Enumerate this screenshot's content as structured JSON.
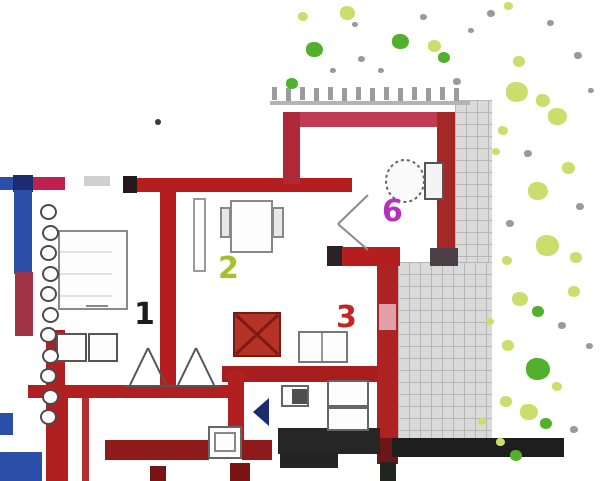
{
  "plan": {
    "canvas": {
      "width": 600,
      "height": 481,
      "background": "#ffffff"
    },
    "room_labels": [
      {
        "name": "room-label-1",
        "text": "1",
        "x": 134,
        "y": 300,
        "color": "#1d1d1d",
        "size": 30
      },
      {
        "name": "room-label-2",
        "text": "2",
        "x": 218,
        "y": 254,
        "color": "#a8bf2c",
        "size": 30
      },
      {
        "name": "room-label-3",
        "text": "3",
        "x": 336,
        "y": 303,
        "color": "#c32424",
        "size": 30
      },
      {
        "name": "room-label-6",
        "text": "6",
        "x": 382,
        "y": 197,
        "color": "#b531bd",
        "size": 30
      }
    ],
    "palette": {
      "wall_red": "#b51e1e",
      "wall_dark_red": "#8e1a1a",
      "wall_rose": "#c23b55",
      "wall_blue": "#2b4fa8",
      "wall_navy": "#1c2a6e",
      "wall_crimson": "#bf2050",
      "tile_gray": "#dadada",
      "band_black": "#1e1e1e",
      "plant_yellow_green": "#cade6e",
      "plant_green": "#53b02c",
      "plant_gray_dot": "#9a9a9a",
      "stove_red": "#b53226"
    },
    "terrace": [
      {
        "name": "terrace-strip-upper",
        "x": 455,
        "y": 100,
        "w": 37,
        "h": 163
      },
      {
        "name": "terrace-main",
        "x": 398,
        "y": 262,
        "w": 94,
        "h": 180
      }
    ],
    "railing": {
      "x0": 272,
      "y": 87,
      "step": 14,
      "count": 14,
      "post_w": 5,
      "post_h": 13,
      "color": "#9c9c9c",
      "line": {
        "x": 270,
        "y": 101,
        "w": 200,
        "h": 4,
        "color": "#b4b4b4"
      }
    },
    "radiator": {
      "x": 40,
      "y0": 204,
      "step": 20.5,
      "count": 11,
      "d": 17
    },
    "walls": [
      {
        "n": "wall-left-blue-h",
        "x": 0,
        "y": 177,
        "w": 14,
        "h": 13,
        "c": "#2b4fa8"
      },
      {
        "n": "wall-left-navy-block",
        "x": 13,
        "y": 175,
        "w": 20,
        "h": 17,
        "c": "#1c2a6e"
      },
      {
        "n": "wall-left-crimson-h",
        "x": 33,
        "y": 177,
        "w": 32,
        "h": 13,
        "c": "#bf2050"
      },
      {
        "n": "wall-left-blue-v",
        "x": 14,
        "y": 190,
        "w": 18,
        "h": 84,
        "c": "#2b4fa8"
      },
      {
        "n": "wall-left-red-v-upper",
        "x": 15,
        "y": 272,
        "w": 18,
        "h": 64,
        "c": "#a03345"
      },
      {
        "n": "wall-left-red-v-lower",
        "x": 46,
        "y": 330,
        "w": 19,
        "h": 151,
        "c": "#b02020"
      },
      {
        "n": "wall-left-red-line",
        "x": 82,
        "y": 397,
        "w": 7,
        "h": 84,
        "c": "#b23030"
      },
      {
        "n": "wall-main-cap-black",
        "x": 123,
        "y": 176,
        "w": 14,
        "h": 17,
        "c": "#27191b"
      },
      {
        "n": "wall-main-red-h",
        "x": 137,
        "y": 178,
        "w": 215,
        "h": 14,
        "c": "#b51e1e"
      },
      {
        "n": "wall-mid-red-v",
        "x": 160,
        "y": 192,
        "w": 16,
        "h": 198,
        "c": "#b51e1e"
      },
      {
        "n": "wall-bath-top",
        "x": 283,
        "y": 112,
        "w": 172,
        "h": 15,
        "c": "#c23b55"
      },
      {
        "n": "wall-bath-left",
        "x": 283,
        "y": 112,
        "w": 17,
        "h": 72,
        "c": "#ad2838"
      },
      {
        "n": "wall-bath-right",
        "x": 437,
        "y": 112,
        "w": 18,
        "h": 140,
        "c": "#a52828"
      },
      {
        "n": "wall-bath-right-cap",
        "x": 430,
        "y": 248,
        "w": 28,
        "h": 18,
        "c": "#4a4045"
      },
      {
        "n": "wall-L-cap-black",
        "x": 327,
        "y": 246,
        "w": 16,
        "h": 20,
        "c": "#2a2226"
      },
      {
        "n": "wall-L-red-h",
        "x": 342,
        "y": 247,
        "w": 58,
        "h": 19,
        "c": "#b51e1e"
      },
      {
        "n": "wall-right-red-v",
        "x": 377,
        "y": 264,
        "w": 21,
        "h": 178,
        "c": "#ad2222"
      },
      {
        "n": "window-right-v",
        "x": 379,
        "y": 304,
        "w": 17,
        "h": 26,
        "c": "#dfa0a8"
      },
      {
        "n": "wall-right-dark-cap",
        "x": 377,
        "y": 438,
        "w": 21,
        "h": 26,
        "c": "#6d1618"
      },
      {
        "n": "wall-right-black-end",
        "x": 380,
        "y": 462,
        "w": 16,
        "h": 19,
        "c": "#20261f"
      },
      {
        "n": "wall-kitchen-red-h",
        "x": 222,
        "y": 366,
        "w": 156,
        "h": 16,
        "c": "#a81d1d"
      },
      {
        "n": "wall-kitchen-red-v",
        "x": 228,
        "y": 371,
        "w": 16,
        "h": 74,
        "c": "#b02020"
      },
      {
        "n": "wall-bottomleft-red-h",
        "x": 28,
        "y": 385,
        "w": 202,
        "h": 13,
        "c": "#b02020"
      },
      {
        "n": "wall-bottomleft-red-v",
        "x": 50,
        "y": 397,
        "w": 18,
        "h": 84,
        "c": "#b02020"
      },
      {
        "n": "band-red-bottom-a",
        "x": 105,
        "y": 440,
        "w": 104,
        "h": 20,
        "c": "#8e1a1a"
      },
      {
        "n": "band-red-bottom-b",
        "x": 242,
        "y": 440,
        "w": 30,
        "h": 20,
        "c": "#8e1a1a"
      },
      {
        "n": "band-black-center",
        "x": 278,
        "y": 428,
        "w": 102,
        "h": 26,
        "c": "#262626"
      },
      {
        "n": "band-black-center-ext",
        "x": 280,
        "y": 452,
        "w": 58,
        "h": 16,
        "c": "#242424"
      },
      {
        "n": "band-black-terrace",
        "x": 392,
        "y": 438,
        "w": 172,
        "h": 19,
        "c": "#1e1e1e"
      },
      {
        "n": "blue-rect-bottom-left",
        "x": 0,
        "y": 452,
        "w": 42,
        "h": 29,
        "c": "#2b4fa8"
      },
      {
        "n": "blue-mark-left",
        "x": 0,
        "y": 413,
        "w": 13,
        "h": 22,
        "c": "#2b4fa8"
      },
      {
        "n": "mark-dark-red-a",
        "x": 150,
        "y": 466,
        "w": 16,
        "h": 15,
        "c": "#7a1414"
      },
      {
        "n": "mark-dark-red-b",
        "x": 230,
        "y": 463,
        "w": 20,
        "h": 18,
        "c": "#7a1414"
      },
      {
        "n": "dot-artifact",
        "x": 155,
        "y": 119,
        "w": 6,
        "h": 6,
        "c": "#3a3a3a",
        "r": 1
      }
    ],
    "stove": {
      "n": "stove",
      "x": 233,
      "y": 312,
      "w": 48,
      "h": 45,
      "fill": "#b53226",
      "border": "#7a1812"
    },
    "fixtures": [
      {
        "n": "bed",
        "x": 58,
        "y": 230,
        "w": 70,
        "h": 80,
        "border": "#8a8a8a"
      },
      {
        "n": "cabinet-a",
        "x": 56,
        "y": 333,
        "w": 31,
        "h": 29,
        "border": "#555555"
      },
      {
        "n": "cabinet-b",
        "x": 88,
        "y": 333,
        "w": 30,
        "h": 29,
        "border": "#555555"
      },
      {
        "n": "door-leaf",
        "x": 193,
        "y": 198,
        "w": 13,
        "h": 74,
        "border": "#999999"
      },
      {
        "n": "table",
        "x": 230,
        "y": 200,
        "w": 43,
        "h": 53,
        "border": "#888888"
      },
      {
        "n": "chair-left",
        "x": 220,
        "y": 207,
        "w": 11,
        "h": 31,
        "border": "#888888",
        "fill": "#e8e8e8"
      },
      {
        "n": "chair-right",
        "x": 272,
        "y": 207,
        "w": 12,
        "h": 31,
        "border": "#888888",
        "fill": "#e8e8e8"
      },
      {
        "n": "kitchen-counter",
        "x": 298,
        "y": 331,
        "w": 50,
        "h": 32,
        "border": "#777777"
      },
      {
        "n": "wc-sink",
        "x": 281,
        "y": 385,
        "w": 28,
        "h": 22,
        "border": "#666666"
      },
      {
        "n": "wc-sink-bowl",
        "x": 292,
        "y": 389,
        "w": 15,
        "h": 15,
        "fill": "#4e4e4e"
      },
      {
        "n": "shower",
        "x": 327,
        "y": 380,
        "w": 42,
        "h": 27,
        "border": "#666666"
      },
      {
        "n": "washer",
        "x": 327,
        "y": 407,
        "w": 42,
        "h": 24,
        "border": "#666666"
      },
      {
        "n": "bottom-fixture",
        "x": 208,
        "y": 426,
        "w": 34,
        "h": 33,
        "border": "#666666"
      },
      {
        "n": "bottom-fixture-inner",
        "x": 214,
        "y": 432,
        "w": 22,
        "h": 20,
        "border": "#888888"
      },
      {
        "n": "toilet-tank",
        "x": 424,
        "y": 162,
        "w": 20,
        "h": 38,
        "border": "#555555",
        "fill": "#f4f4f4"
      },
      {
        "n": "gray-dash",
        "x": 84,
        "y": 176,
        "w": 26,
        "h": 10,
        "fill": "#d0d0d0"
      }
    ],
    "toilet_bowl": {
      "n": "toilet-bowl",
      "cx": 405,
      "cy": 181,
      "rx": 19,
      "ry": 21,
      "stroke": "#666666",
      "dash": "3,3"
    },
    "door_arrow": {
      "n": "door-arrow",
      "points": "269,398 253,412 269,426",
      "fill": "#1c2a6e"
    },
    "line_groups": [
      {
        "n": "stairs-lines",
        "stroke": "#555555",
        "w": 2,
        "segs": [
          [
            125,
            386,
            220,
            386
          ],
          [
            130,
            385,
            148,
            348
          ],
          [
            148,
            348,
            166,
            385
          ],
          [
            178,
            385,
            196,
            348
          ],
          [
            196,
            348,
            214,
            385
          ]
        ]
      },
      {
        "n": "door-swing-lines",
        "stroke": "#8a8a8a",
        "w": 2,
        "segs": [
          [
            368,
            195,
            338,
            224
          ],
          [
            338,
            224,
            368,
            250
          ]
        ]
      },
      {
        "n": "stove-x-lines",
        "stroke": "#7f1a12",
        "w": 3,
        "segs": [
          [
            236,
            315,
            278,
            354
          ],
          [
            278,
            315,
            236,
            354
          ]
        ]
      },
      {
        "n": "counter-divider",
        "stroke": "#777777",
        "w": 1.5,
        "segs": [
          [
            322,
            333,
            322,
            361
          ]
        ]
      },
      {
        "n": "shelf-lines",
        "stroke": "#c8c8c8",
        "w": 1,
        "segs": [
          [
            60,
            252,
            112,
            252
          ],
          [
            60,
            274,
            112,
            274
          ],
          [
            60,
            296,
            112,
            296
          ]
        ]
      },
      {
        "n": "bed-notch",
        "stroke": "#888888",
        "w": 2,
        "segs": [
          [
            86,
            306,
            108,
            306
          ]
        ]
      }
    ],
    "plants": [
      {
        "x": 340,
        "y": 6,
        "s": 15,
        "t": "yg"
      },
      {
        "x": 298,
        "y": 12,
        "s": 10,
        "t": "yg"
      },
      {
        "x": 352,
        "y": 22,
        "s": 6,
        "t": "gray"
      },
      {
        "x": 306,
        "y": 42,
        "s": 17,
        "t": "g"
      },
      {
        "x": 392,
        "y": 34,
        "s": 17,
        "t": "g"
      },
      {
        "x": 428,
        "y": 40,
        "s": 13,
        "t": "yg"
      },
      {
        "x": 358,
        "y": 56,
        "s": 7,
        "t": "gray"
      },
      {
        "x": 286,
        "y": 78,
        "s": 12,
        "t": "g"
      },
      {
        "x": 438,
        "y": 52,
        "s": 12,
        "t": "g"
      },
      {
        "x": 468,
        "y": 28,
        "s": 6,
        "t": "gray"
      },
      {
        "x": 487,
        "y": 10,
        "s": 8,
        "t": "gray"
      },
      {
        "x": 420,
        "y": 14,
        "s": 7,
        "t": "gray"
      },
      {
        "x": 453,
        "y": 78,
        "s": 8,
        "t": "gray"
      },
      {
        "x": 378,
        "y": 68,
        "s": 6,
        "t": "gray"
      },
      {
        "x": 330,
        "y": 68,
        "s": 6,
        "t": "gray"
      },
      {
        "x": 504,
        "y": 2,
        "s": 9,
        "t": "yg"
      },
      {
        "x": 547,
        "y": 20,
        "s": 7,
        "t": "gray"
      },
      {
        "x": 574,
        "y": 52,
        "s": 8,
        "t": "gray"
      },
      {
        "x": 513,
        "y": 56,
        "s": 12,
        "t": "yg"
      },
      {
        "x": 506,
        "y": 82,
        "s": 22,
        "t": "yg"
      },
      {
        "x": 536,
        "y": 94,
        "s": 14,
        "t": "yg"
      },
      {
        "x": 588,
        "y": 88,
        "s": 6,
        "t": "gray"
      },
      {
        "x": 548,
        "y": 108,
        "s": 19,
        "t": "yg"
      },
      {
        "x": 498,
        "y": 126,
        "s": 10,
        "t": "yg"
      },
      {
        "x": 524,
        "y": 150,
        "s": 8,
        "t": "gray"
      },
      {
        "x": 562,
        "y": 162,
        "s": 13,
        "t": "yg"
      },
      {
        "x": 528,
        "y": 182,
        "s": 20,
        "t": "yg"
      },
      {
        "x": 576,
        "y": 203,
        "s": 8,
        "t": "gray"
      },
      {
        "x": 506,
        "y": 220,
        "s": 8,
        "t": "gray"
      },
      {
        "x": 536,
        "y": 235,
        "s": 23,
        "t": "yg"
      },
      {
        "x": 570,
        "y": 252,
        "s": 12,
        "t": "yg"
      },
      {
        "x": 502,
        "y": 256,
        "s": 10,
        "t": "yg"
      },
      {
        "x": 568,
        "y": 286,
        "s": 12,
        "t": "yg"
      },
      {
        "x": 512,
        "y": 292,
        "s": 16,
        "t": "yg"
      },
      {
        "x": 532,
        "y": 306,
        "s": 12,
        "t": "g"
      },
      {
        "x": 558,
        "y": 322,
        "s": 8,
        "t": "gray"
      },
      {
        "x": 502,
        "y": 340,
        "s": 12,
        "t": "yg"
      },
      {
        "x": 586,
        "y": 343,
        "s": 7,
        "t": "gray"
      },
      {
        "x": 526,
        "y": 358,
        "s": 24,
        "t": "g"
      },
      {
        "x": 552,
        "y": 382,
        "s": 10,
        "t": "yg"
      },
      {
        "x": 500,
        "y": 396,
        "s": 12,
        "t": "yg"
      },
      {
        "x": 520,
        "y": 404,
        "s": 18,
        "t": "yg"
      },
      {
        "x": 540,
        "y": 418,
        "s": 12,
        "t": "g"
      },
      {
        "x": 570,
        "y": 426,
        "s": 8,
        "t": "gray"
      },
      {
        "x": 510,
        "y": 450,
        "s": 12,
        "t": "g"
      },
      {
        "x": 492,
        "y": 148,
        "s": 8,
        "t": "yg"
      },
      {
        "x": 486,
        "y": 318,
        "s": 8,
        "t": "yg"
      },
      {
        "x": 478,
        "y": 418,
        "s": 8,
        "t": "yg"
      },
      {
        "x": 496,
        "y": 438,
        "s": 9,
        "t": "yg"
      }
    ]
  }
}
